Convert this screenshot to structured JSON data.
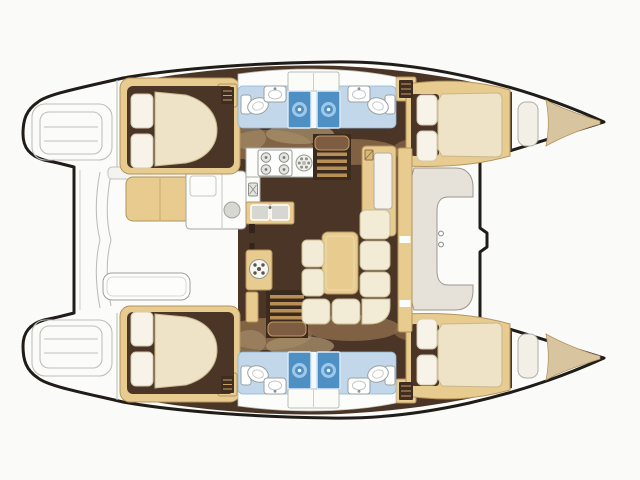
{
  "figure": {
    "type": "floor-plan",
    "subject": "catamaran sailboat deck plan",
    "view": "overhead 2D layout drawing",
    "orientation": "bow-right, stern-left",
    "symmetry": "port and starboard hulls mirrored about horizontal centerline",
    "text_content": "none (drawing only)"
  },
  "colors": {
    "background": "#fafaf8",
    "outline": "#201d18",
    "deck": "#fbfbf9",
    "deck_line": "#bfbfb9",
    "wood_tan": "#e8cb8e",
    "wood_tan_stroke": "#b3945e",
    "landing_brown": "#7d5c41",
    "tread_tan": "#b98f58",
    "bow_tan": "#d8c5a0",
    "floor_dark": "#4a3527",
    "floor_mid": "#8a684a",
    "floor_light": "#a8916d",
    "dark_wood": "#3b2b1e",
    "upholstery": "#eee3c6",
    "sofa_cream": "#f2ebd5",
    "pillow": "#f7f3e8",
    "bathroom_blue": "#c2d8ea",
    "shower_blue": "#4e8fc4",
    "shower_ring": "#9fc8e8",
    "fixture_white": "#ffffff",
    "fixture_stroke": "#98a0a2",
    "module_gray": "#d8d8d2",
    "seat_beige": "#e6e1d9"
  },
  "rooms": {
    "center": [
      {
        "id": "aft-cockpit",
        "name": "aft cockpit",
        "fixtures": [
          "bench seat",
          "wet-bar module with round sink",
          "cockpit table",
          "deck hatch",
          "transom platform"
        ]
      },
      {
        "id": "saloon",
        "name": "saloon",
        "fixtures": [
          "L-shaped sofa",
          "dining table",
          "navigation cabinet",
          "round instrument cabinet",
          "companionway stairs port",
          "companionway stairs starboard"
        ]
      },
      {
        "id": "galley",
        "name": "galley",
        "fixtures": [
          "4-burner stove",
          "round burner",
          "double sink",
          "appliance column"
        ]
      },
      {
        "id": "forward-cockpit",
        "name": "forward cockpit",
        "fixtures": [
          "curved lounge seat",
          "walk-through with handles",
          "forward crossbeam"
        ]
      }
    ],
    "each_hull": [
      {
        "id": "transom-steps",
        "name": "transom swim steps"
      },
      {
        "id": "aft-cabin",
        "name": "aft double cabin",
        "fixtures": [
          "double berth",
          "two pillows",
          "louver locker"
        ]
      },
      {
        "id": "shower-room-aft",
        "name": "aft head",
        "fixtures": [
          "shower",
          "toilet",
          "washbasin"
        ]
      },
      {
        "id": "shower-room-fwd",
        "name": "forward head",
        "fixtures": [
          "shower",
          "toilet",
          "washbasin",
          "louver locker"
        ]
      },
      {
        "id": "forward-cabin",
        "name": "forward double cabin",
        "fixtures": [
          "double berth",
          "two pillows",
          "bow seat",
          "bow storage wedge"
        ]
      }
    ]
  },
  "counts": {
    "cabins": 4,
    "showers": 4,
    "toilets": 4,
    "washbasins": 4,
    "stove_burners": 4,
    "galley_sinks": 2,
    "companionways": 2
  }
}
